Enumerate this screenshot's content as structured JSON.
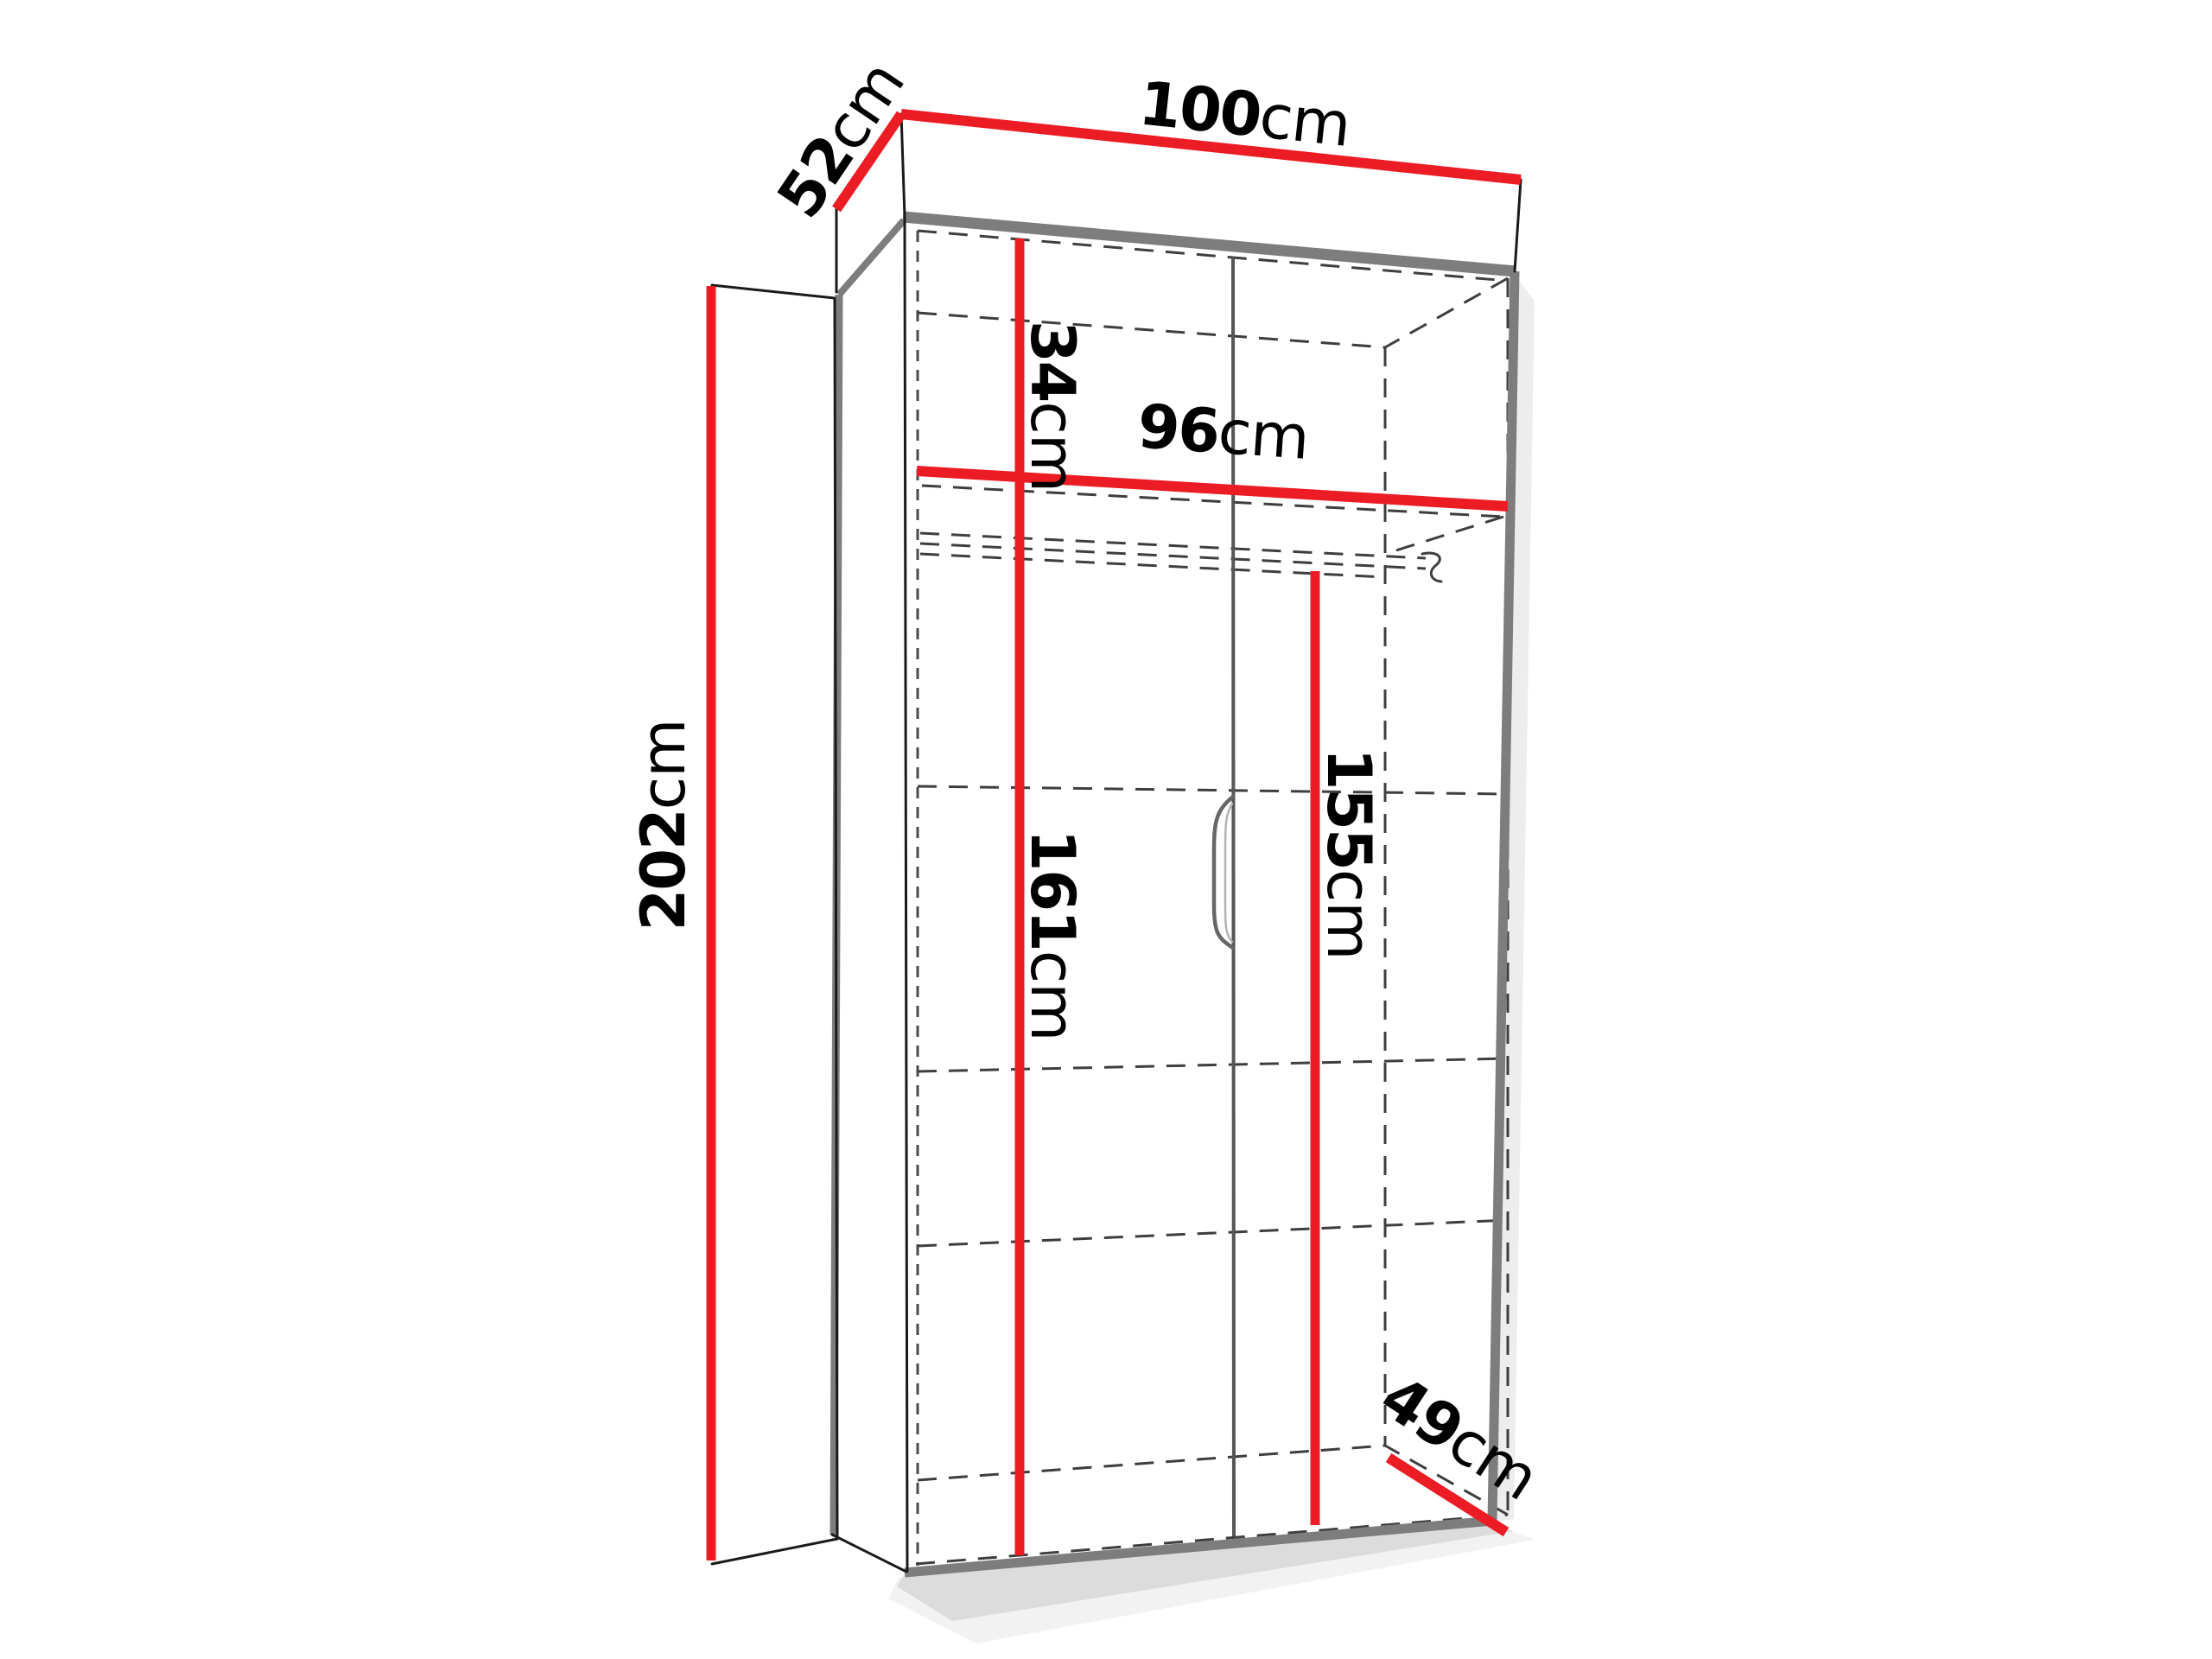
{
  "diagram": {
    "kind": "wardrobe-dimension-diagram",
    "unit": "cm",
    "accent_color": "#ec1c24",
    "edge_color": "#7d7d7d",
    "outline_color": "#1a1a1a",
    "dashed_color": "#3e3e3e"
  },
  "dimensions": {
    "width_top": {
      "value": "100",
      "unit": "cm"
    },
    "depth_top": {
      "value": "52",
      "unit": "cm"
    },
    "height_side": {
      "value": "202",
      "unit": "cm"
    },
    "top_compartment": {
      "value": "34",
      "unit": "cm"
    },
    "interior_width": {
      "value": "96",
      "unit": "cm"
    },
    "interior_height": {
      "value": "161",
      "unit": "cm"
    },
    "hanging_height": {
      "value": "155",
      "unit": "cm"
    },
    "depth_bottom": {
      "value": "49",
      "unit": "cm"
    }
  }
}
